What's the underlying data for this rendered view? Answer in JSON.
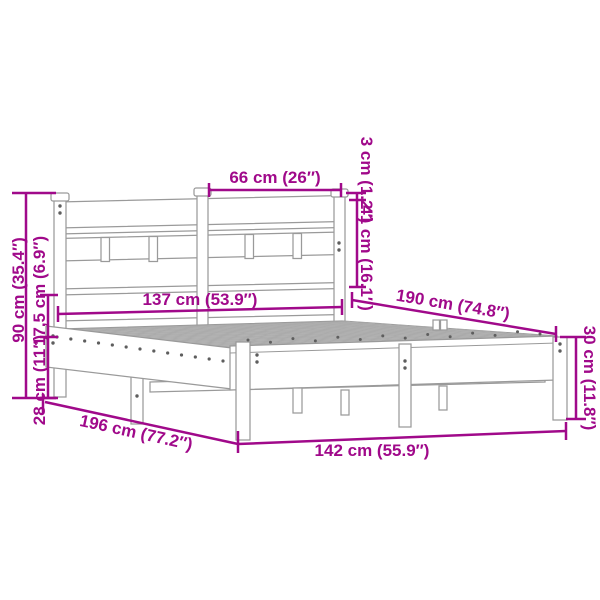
{
  "colors": {
    "dimension": "#A0098A",
    "frame_outline": "#9A9A9A",
    "deck_fill": "#ECECEC",
    "background": "#FFFFFF"
  },
  "labels": {
    "headboard_section_width": "66 cm (26″)",
    "top_rail_gap": "3 cm (1.2″)",
    "headboard_panel_height": "41 cm (16.1″)",
    "headboard_height": "90 cm (35.4″)",
    "side_rail_height": "17,5 cm (6.9″)",
    "under_bed_clearance": "28 cm (11″)",
    "inner_width": "137 cm (53.9″)",
    "inner_length": "190 cm (74.8″)",
    "footboard_height": "30 cm (11.8″)",
    "total_length": "196 cm (77.2″)",
    "total_width": "142 cm (55.9″)"
  }
}
